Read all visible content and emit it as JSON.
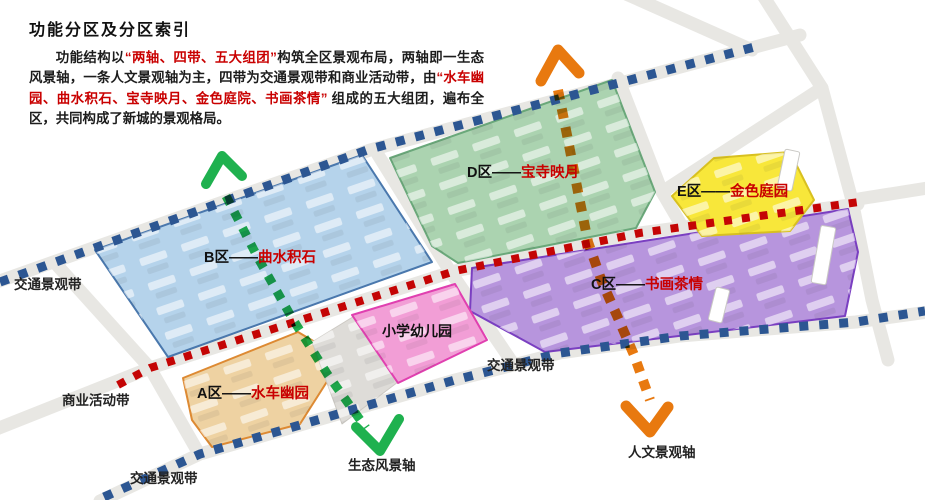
{
  "header": {
    "title": "功能分区及分区索引"
  },
  "intro": {
    "p1": "功能结构以",
    "q1": "“两轴、四带、五大组团”",
    "p2": "构筑全区景观布局，两轴即一生态风景轴，一条人文景观轴为主，四带为交通景观带和商业活动带，由",
    "q2": "“水车幽园、曲水积石、宝寺映月、金色庭院、书画茶情”",
    "p3": " 组成的五大组团，遍布全区，共同构成了新城的景观格局。"
  },
  "zones": [
    {
      "id": "A",
      "prefix": "A区——",
      "name": "水车幽园",
      "fill": "#eed2a2",
      "stroke": "#dd8a33"
    },
    {
      "id": "B",
      "prefix": "B区——",
      "name": "曲水积石",
      "fill": "#b5d3eb",
      "stroke": "#4a78ad"
    },
    {
      "id": "C",
      "prefix": "C区——",
      "name": "书画茶情",
      "fill": "#b795dd",
      "stroke": "#7a3fc1"
    },
    {
      "id": "D",
      "prefix": "D区——",
      "name": "宝寺映月",
      "fill": "#abd3b0",
      "stroke": "#6aa87a"
    },
    {
      "id": "E",
      "prefix": "E区——",
      "name": "金色庭园",
      "fill": "#f8e73a",
      "stroke": "#d8c020"
    }
  ],
  "school": {
    "label": "小学幼儿园",
    "fill": "#f29ed6",
    "stroke": "#e040b0"
  },
  "bands": {
    "traffic_label": "交通景观带",
    "commercial_label": "商业活动带",
    "traffic_color": "#2c5692",
    "commercial_color": "#c40505"
  },
  "axes": {
    "eco": {
      "label": "生态风景轴",
      "color": "#1fb14f"
    },
    "culture": {
      "label": "人文景观轴",
      "color": "#e8790f"
    }
  },
  "label_color": "#c90000"
}
